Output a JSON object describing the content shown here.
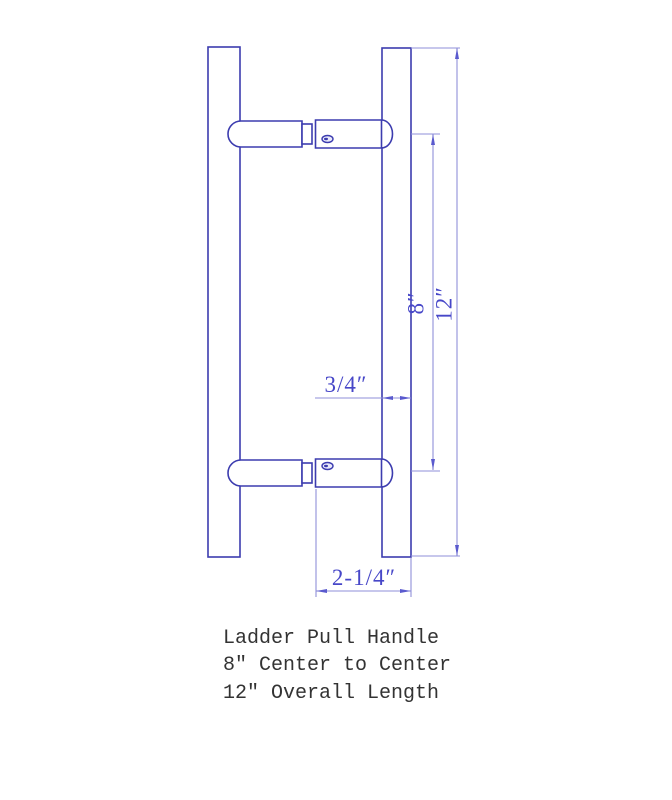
{
  "drawing": {
    "type": "technical-dimension-drawing",
    "subject": "Ladder Pull Handle",
    "dimensions": {
      "bar_diameter": {
        "label": "3/4″"
      },
      "projection": {
        "label": "2-1/4″"
      },
      "center_to_center": {
        "label": "8″"
      },
      "overall_length": {
        "label": "12″"
      }
    }
  },
  "caption": {
    "lines": [
      "Ladder Pull Handle",
      "8″ Center to Center",
      "12″ Overall Length"
    ]
  },
  "colors": {
    "outline": "#3c3caf",
    "dim_line": "#8f8fd8",
    "arrow": "#5a5ace",
    "dim_text": "#4747c8",
    "caption_text": "#333333",
    "bg": "#ffffff"
  }
}
